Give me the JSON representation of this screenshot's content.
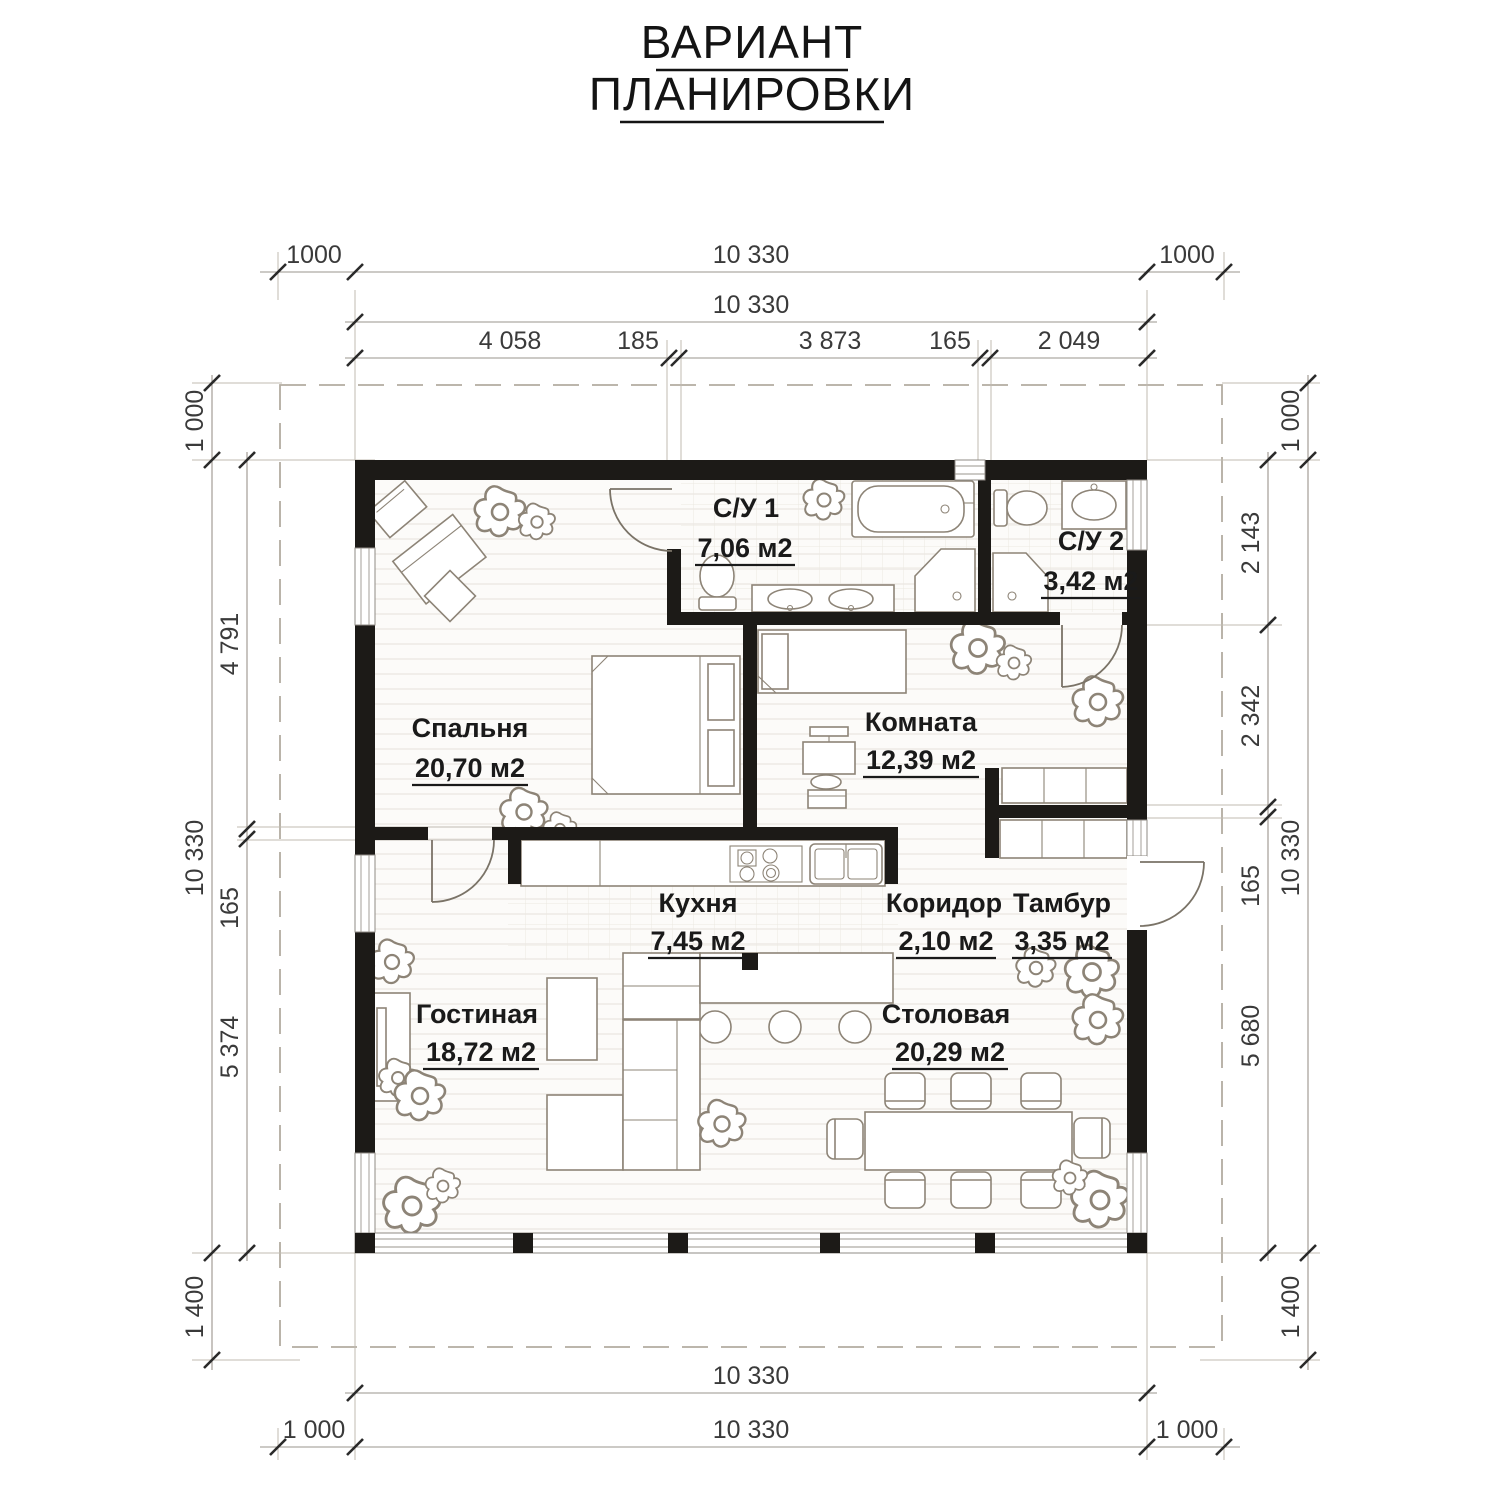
{
  "title": {
    "line1": "ВАРИАНТ",
    "line2": "ПЛАНИРОВКИ"
  },
  "rooms": {
    "bedroom": {
      "name": "Спальня",
      "area": "20,70 м2"
    },
    "bath1": {
      "name": "С/У 1",
      "area": "7,06 м2"
    },
    "bath2": {
      "name": "С/У 2",
      "area": "3,42 м2"
    },
    "room": {
      "name": "Комната",
      "area": "12,39 м2"
    },
    "kitchen": {
      "name": "Кухня",
      "area": "7,45 м2"
    },
    "corridor": {
      "name": "Коридор",
      "area": "2,10 м2"
    },
    "vestibule": {
      "name": "Тамбур",
      "area": "3,35 м2"
    },
    "living": {
      "name": "Гостиная",
      "area": "18,72 м2"
    },
    "dining": {
      "name": "Столовая",
      "area": "20,29 м2"
    }
  },
  "dimensions": {
    "top_row1": {
      "left": "1000",
      "center": "10 330",
      "right": "1000"
    },
    "top_row2": "10 330",
    "top_row3": [
      "4 058",
      "185",
      "3 873",
      "165",
      "2 049"
    ],
    "left_outer": {
      "top": "1 000",
      "center": "10 330",
      "bottom": "1 400"
    },
    "left_inner": [
      "4 791",
      "165",
      "5 374"
    ],
    "right_inner": [
      "2 143",
      "2 342",
      "165",
      "5 680"
    ],
    "right_outer": {
      "top": "1 000",
      "center": "10 330",
      "bottom": "1 400"
    },
    "bottom_row1": "10 330",
    "bottom_row2": {
      "left": "1 000",
      "center": "10 330",
      "right": "1 000"
    }
  },
  "colors": {
    "wall": "#1c1a17",
    "furniture_line": "#8d8477",
    "dimension_line": "#9a948c",
    "dimension_text": "#3a3a3a",
    "label_text": "#1a1a1a",
    "background": "#ffffff"
  }
}
